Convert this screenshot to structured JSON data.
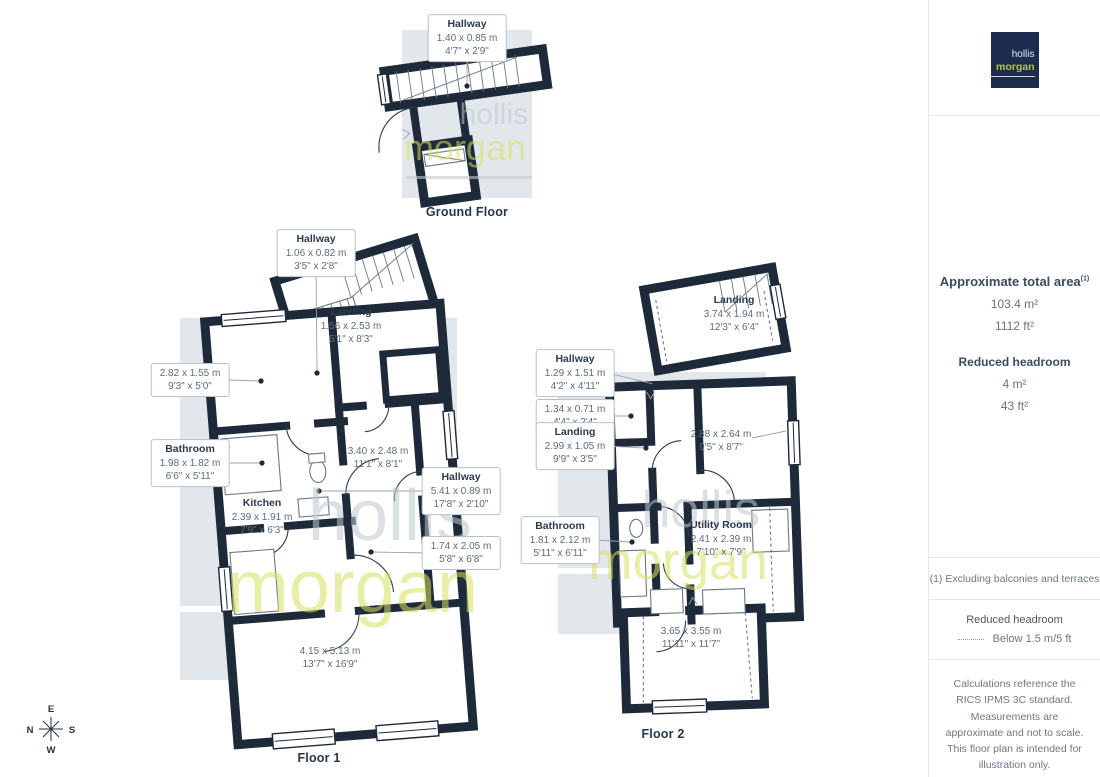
{
  "titles": {
    "ground": "Ground Floor",
    "floor1": "Floor 1",
    "floor2": "Floor 2"
  },
  "ground": {
    "labels": [
      {
        "name": "Hallway",
        "metric": "1.40 x 0.85 m",
        "imperial": "4'7\" x 2'9\""
      }
    ]
  },
  "floor1": {
    "labels": [
      {
        "name": "Hallway",
        "metric": "1.06 x 0.82 m",
        "imperial": "3'5\" x 2'8\""
      },
      {
        "name": "Landing",
        "metric": "1.56 x 2.53 m",
        "imperial": "5'1\" x 8'3\""
      },
      {
        "metric": "2.82 x 1.55 m",
        "imperial": "9'3\" x 5'0\""
      },
      {
        "name": "Bathroom",
        "metric": "1.98 x 1.82 m",
        "imperial": "6'6\" x 5'11\""
      },
      {
        "name": "Kitchen",
        "metric": "2.39 x 1.91 m",
        "imperial": "7'9\" x 6'3\""
      },
      {
        "metric": "3.40 x 2.48 m",
        "imperial": "11'1\" x 8'1\""
      },
      {
        "name": "Hallway",
        "metric": "5.41 x 0.89 m",
        "imperial": "17'8\" x 2'10\""
      },
      {
        "metric": "1.74 x 2.05 m",
        "imperial": "5'8\" x 6'8\""
      },
      {
        "metric": "4.15 x 5.13 m",
        "imperial": "13'7\" x 16'9\""
      }
    ]
  },
  "floor2": {
    "labels": [
      {
        "name": "Landing",
        "metric": "3.74 x 1.94 m",
        "imperial": "12'3\" x 6'4\""
      },
      {
        "name": "Hallway",
        "metric": "1.29 x 1.51 m",
        "imperial": "4'2\" x 4'11\""
      },
      {
        "metric": "1.34 x 0.71 m",
        "imperial": "4'4\" x 2'4\""
      },
      {
        "name": "Landing",
        "metric": "2.99 x 1.05 m",
        "imperial": "9'9\" x 3'5\""
      },
      {
        "metric": "2.88 x 2.64 m",
        "imperial": "9'5\" x 8'7\""
      },
      {
        "name": "Bathroom",
        "metric": "1.81 x 2.12 m",
        "imperial": "5'11\" x 6'11\""
      },
      {
        "name": "Utility Room",
        "metric": "2.41 x 2.39 m",
        "imperial": "7'10\" x 7'9\""
      },
      {
        "metric": "3.65 x 3.55 m",
        "imperial": "11'11\" x 11'7\""
      }
    ]
  },
  "sidebar": {
    "area_title": "Approximate total area",
    "area_sup": "(1)",
    "area_m2": "103.4 m²",
    "area_ft2": "1112 ft²",
    "headroom_title": "Reduced headroom",
    "headroom_m2": "4 m²",
    "headroom_ft2": "43 ft²",
    "footnote": "(1) Excluding balconies and terraces",
    "legend_title": "Reduced headroom",
    "legend_value": "Below 1.5 m/5 ft",
    "disclaimer": "Calculations reference the RICS IPMS 3C standard. Measurements are approximate and not to scale. This floor plan is intended for illustration only.",
    "brand": "GIRAFFE",
    "brand_bold": "360"
  },
  "logo": {
    "line1": "hollis",
    "line2": "morgan"
  },
  "watermark": {
    "line1": "hollis",
    "line2": "morgan"
  },
  "compass": {
    "top": "E",
    "left": "N",
    "right": "S",
    "bottom": "W"
  },
  "colors": {
    "wall": "#1e2a3a",
    "logo_navy": "#1d2b4e",
    "logo_green": "#b5c832",
    "backdrop": "#e2e7ec"
  }
}
